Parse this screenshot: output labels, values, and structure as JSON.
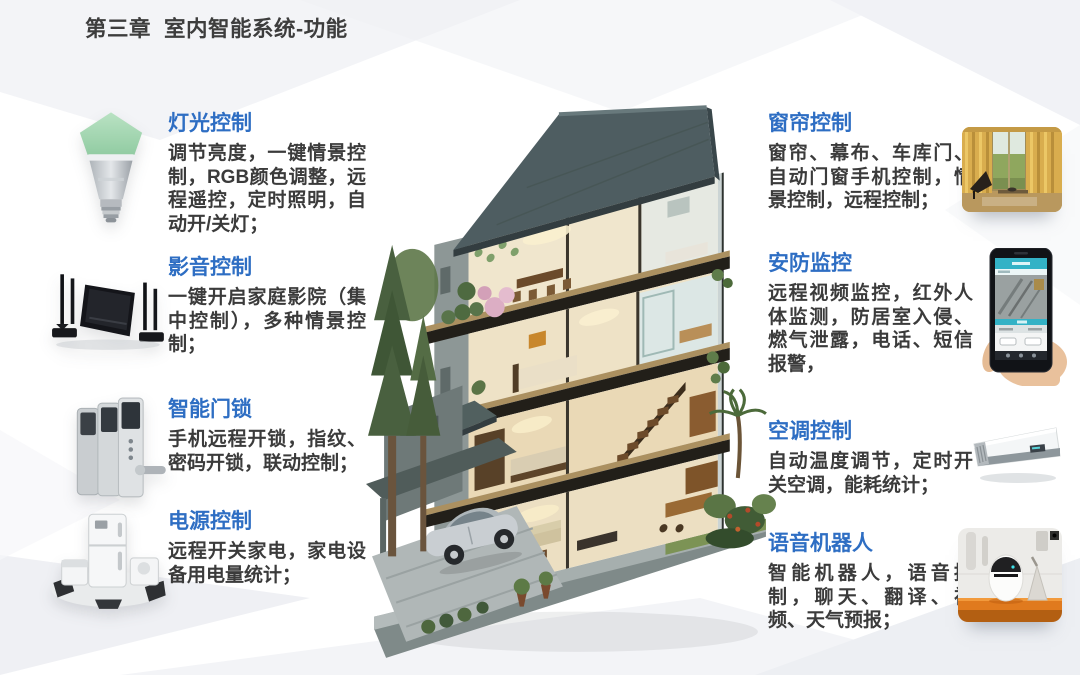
{
  "slide": {
    "title": "第三章  室内智能系统-功能"
  },
  "colors": {
    "heading_blue": "#2e6ec3",
    "body_text": "#3b3b3b",
    "background": "#ffffff",
    "roof_slate": "#4e5d61",
    "shelf_orange": "#e07a1e",
    "app_teal": "#33b2c6"
  },
  "center_illustration": {
    "name": "smart-home-cutaway-house",
    "description": "four-story cutaway villa with interior rooms, trees, garage and car"
  },
  "left_features": [
    {
      "icon": "smart-bulb-icon",
      "title": "灯光控制",
      "desc": "调节亮度，一键情景控制，RGB颜色调整，远程遥控，定时照明，自动开/关灯；"
    },
    {
      "icon": "home-theater-icon",
      "title": "影音控制",
      "desc": "一键开启家庭影院（集中控制），多种情景控制；"
    },
    {
      "icon": "door-lock-icon",
      "title": "智能门锁",
      "desc": "手机远程开锁，指纹、密码开锁，联动控制；"
    },
    {
      "icon": "appliance-power-icon",
      "title": "电源控制",
      "desc": "远程开关家电，家电设备用电量统计；"
    }
  ],
  "right_features": [
    {
      "image": "curtain-photo",
      "title": "窗帘控制",
      "desc": "窗帘、幕布、车库门、自动门窗手机控制，情景控制，远程控制；"
    },
    {
      "image": "security-phone-photo",
      "title": "安防监控",
      "desc": "远程视频监控，红外人体监测，防居室入侵、燃气泄露，电话、短信报警，"
    },
    {
      "image": "air-conditioner-photo",
      "title": "空调控制",
      "desc": "自动温度调节，定时开关空调，能耗统计；"
    },
    {
      "image": "voice-robot-photo",
      "title": "语音机器人",
      "desc": "智能机器人，语音控制，聊天、翻译、视频、天气预报；"
    }
  ]
}
